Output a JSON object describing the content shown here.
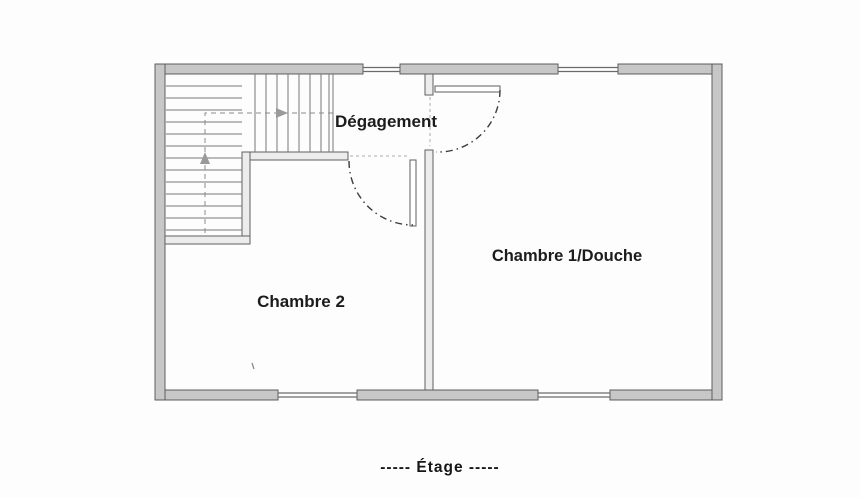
{
  "plan": {
    "rooms": {
      "degagement": {
        "label": "Dégagement"
      },
      "chambre1": {
        "label": "Chambre 1/Douche"
      },
      "chambre2": {
        "label": "Chambre 2"
      }
    },
    "caption": "-----  Étage  -----",
    "icons": {
      "stair_up_arrow": "up-arrow",
      "stair_right_arrow": "right-arrow"
    },
    "colors": {
      "background": "#fdfdfd",
      "wall_fill": "#cecece",
      "wall_edge": "#5f5f5f",
      "interior_wall_fill": "#ececec",
      "tread_line": "#787878",
      "door_arc": "#3c3c3c",
      "text": "#1c1c1c"
    }
  }
}
